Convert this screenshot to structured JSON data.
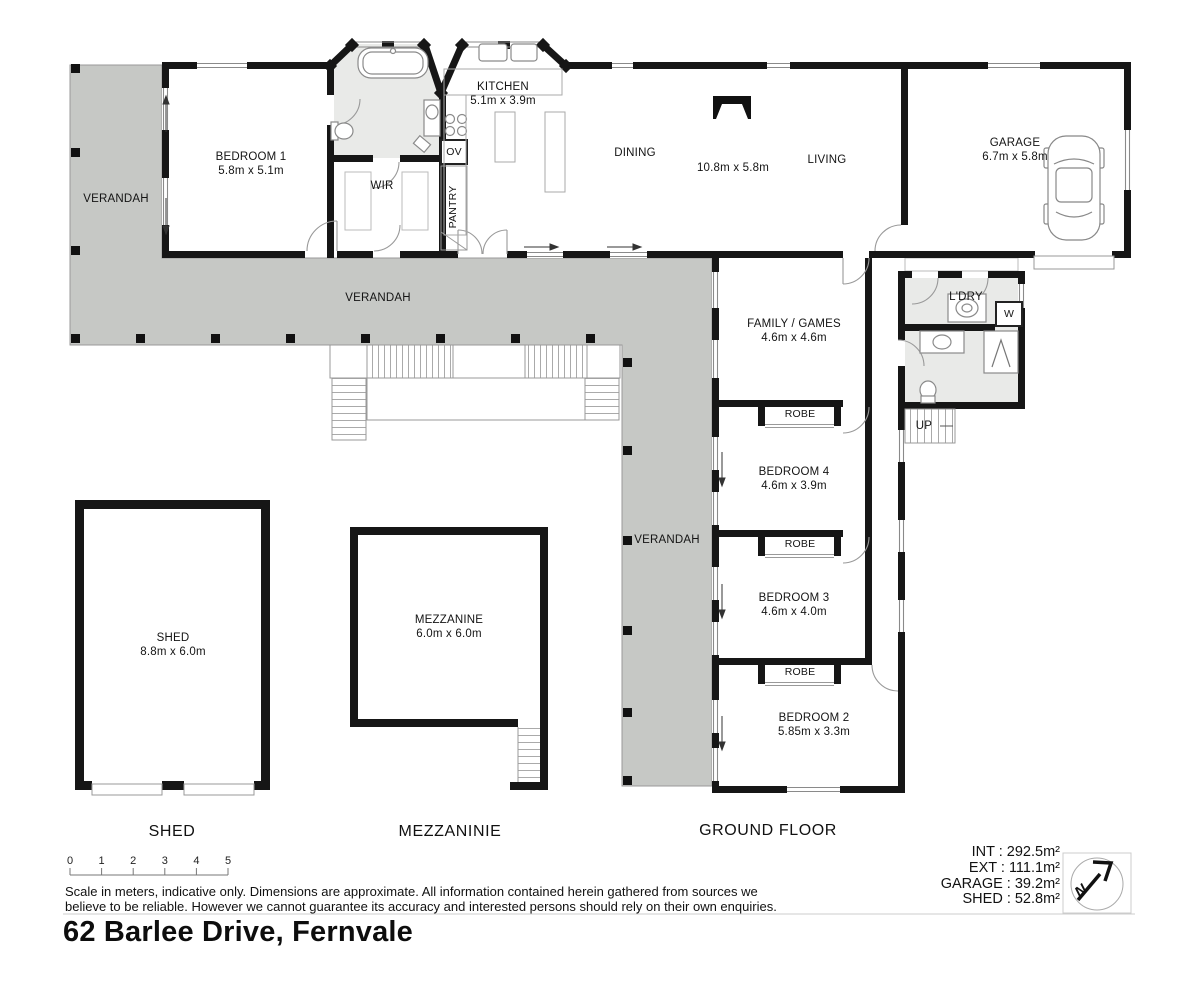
{
  "address": "62 Barlee Drive, Fernvale",
  "colors": {
    "wall": "#161616",
    "verandah_fill": "#c6c8c5",
    "wet_area_fill": "#e9eae8",
    "thin_line": "#999999"
  },
  "rooms": {
    "bedroom1": {
      "name": "BEDROOM 1",
      "dims": "5.8m x 5.1m"
    },
    "kitchen": {
      "name": "KITCHEN",
      "dims": "5.1m x 3.9m"
    },
    "garage": {
      "name": "GARAGE",
      "dims": "6.7m x 5.8m"
    },
    "family": {
      "name": "FAMILY / GAMES",
      "dims": "4.6m x 4.6m"
    },
    "bedroom4": {
      "name": "BEDROOM 4",
      "dims": "4.6m x 3.9m"
    },
    "bedroom3": {
      "name": "BEDROOM 3",
      "dims": "4.6m x 4.0m"
    },
    "bedroom2": {
      "name": "BEDROOM 2",
      "dims": "5.85m x 3.3m"
    },
    "shed": {
      "name": "SHED",
      "dims": "8.8m x 6.0m"
    },
    "mezzanine": {
      "name": "MEZZANINE",
      "dims": "6.0m x 6.0m"
    }
  },
  "labels": {
    "verandah_left": "VERANDAH",
    "verandah_top": "VERANDAH",
    "verandah_side": "VERANDAH",
    "dining": "DINING",
    "living": "LIVING",
    "living_dims": "10.8m x 5.8m",
    "wir": "WIR",
    "ov": "OV",
    "pantry": "PANTRY",
    "ldry": "L'DRY",
    "washer": "W",
    "up": "UP",
    "robe1": "ROBE",
    "robe2": "ROBE",
    "robe3": "ROBE"
  },
  "floor_titles": {
    "shed": "SHED",
    "mezzanine": "MEZZANINIE",
    "ground": "GROUND FLOOR"
  },
  "scale_bar": {
    "ticks": [
      "0",
      "1",
      "2",
      "3",
      "4",
      "5"
    ]
  },
  "disclaimer": {
    "line1": "Scale in meters, indicative only. Dimensions are approximate. All information contained herein gathered from sources we",
    "line2": "believe to be reliable. However we cannot guarantee its accuracy and interested persons should rely on their own enquiries."
  },
  "areas": [
    {
      "text": "INT : 292.5m²"
    },
    {
      "text": "EXT : 111.1m²"
    },
    {
      "text": "GARAGE : 39.2m²"
    },
    {
      "text": "SHED : 52.8m²"
    }
  ],
  "compass": {
    "letter": "N"
  },
  "icons": {
    "compass": "north-arrow-icon",
    "bath": "bathtub-icon",
    "car": "car-icon",
    "fireplace": "fireplace-icon",
    "washer": "washing-machine-icon"
  }
}
